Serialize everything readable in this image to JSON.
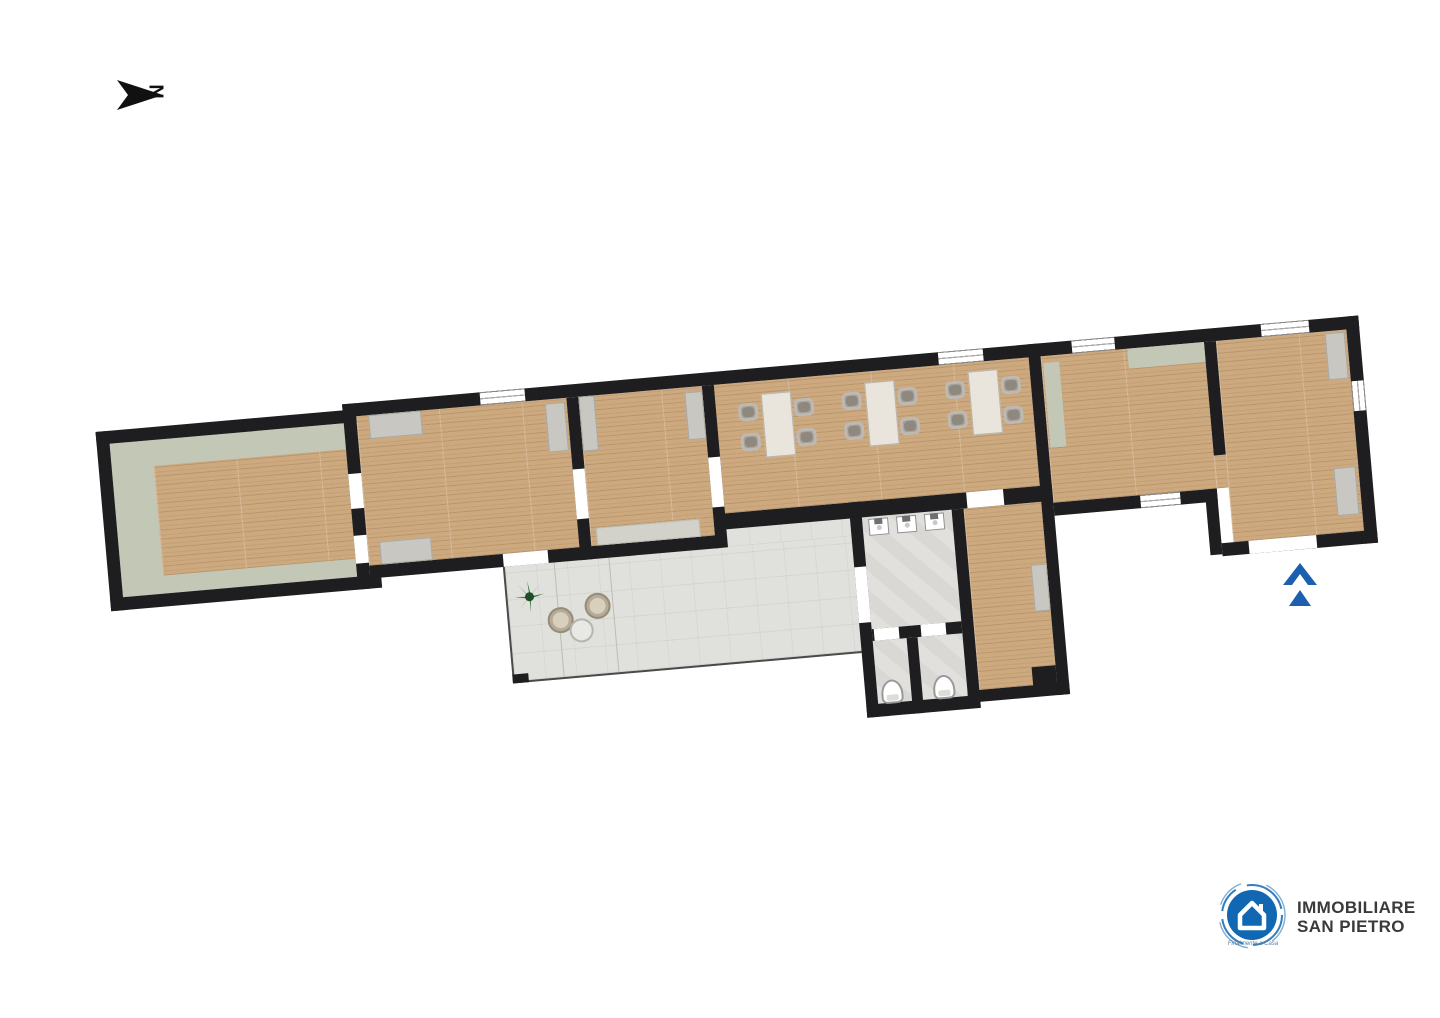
{
  "canvas": {
    "width": 1440,
    "height": 1018,
    "background": "#ffffff"
  },
  "north_indicator": {
    "label": "N"
  },
  "entrance": {
    "direction": "up",
    "color": "#1c5fae"
  },
  "logo": {
    "line1": "IMMOBILIARE",
    "line2": "SAN PIETRO",
    "tagline": "Finalmente a Casa",
    "circle_color": "#1167b1",
    "text_color": "#3a3a3c"
  },
  "floorplan": {
    "rotation_deg": -5,
    "colors": {
      "wall": "#1e1e20",
      "wood": "#cda97f",
      "sage": "#c3c7b6",
      "radiator": "#c8c7c1",
      "terrace": "#e0e0dc",
      "bath": "#dad8d4",
      "table": "#e9e5dd",
      "chair": "#a8a29a"
    },
    "rooms": [
      {
        "id": "room-a",
        "floor": "wood-with-sage-border"
      },
      {
        "id": "room-b",
        "floor": "wood",
        "radiators": 3
      },
      {
        "id": "room-c",
        "floor": "wood",
        "radiators": 2
      },
      {
        "id": "hall",
        "floor": "wood",
        "tables": 3,
        "chairs_per_table": 4
      },
      {
        "id": "room-e",
        "floor": "wood",
        "radiators": 1
      },
      {
        "id": "room-f",
        "floor": "wood",
        "radiators": 2,
        "entrance_door": true
      },
      {
        "id": "terrace",
        "floor": "stone-tile",
        "plant": 1,
        "armchairs": 2,
        "side_table": 1
      },
      {
        "id": "bathroom-anteroom",
        "floor": "tile",
        "sinks": 3
      },
      {
        "id": "wc-1",
        "floor": "tile",
        "toilets": 1
      },
      {
        "id": "wc-2",
        "floor": "tile",
        "toilets": 1
      },
      {
        "id": "corridor",
        "floor": "wood",
        "radiators": 1
      }
    ]
  }
}
